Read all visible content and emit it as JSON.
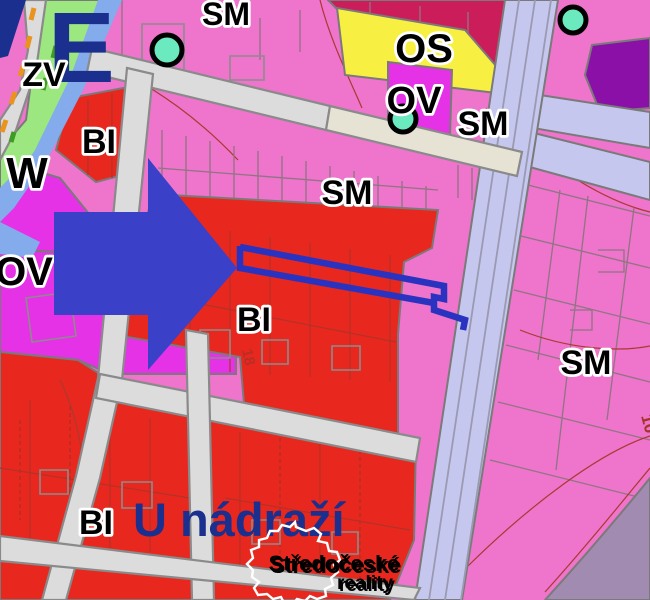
{
  "map": {
    "city_label_partial": "E",
    "street_label": "U nádraží",
    "zone_labels": {
      "sm": "SM",
      "os": "OS",
      "ov": "OV",
      "bi": "BI",
      "zv": "ZV",
      "w": "W"
    },
    "parcel_numbers": {
      "center": "18",
      "top_right": "10"
    },
    "watermark": {
      "brand_line1": "Středočeské",
      "brand_line2": "reality"
    },
    "colors": {
      "sm_pink": "#ee74cc",
      "bi_red": "#e8281e",
      "ov_magenta": "#e632e6",
      "os_yellow": "#f8ef43",
      "zv_green": "#9ce77f",
      "crimson_zone": "#cc1d5b",
      "dark_purple_zone": "#8a10a8",
      "rail_lavender": "#c5c7ef",
      "water_blue": "#84abec",
      "road_gray": "#dcdcdc",
      "road_beige": "#e6e2d4",
      "muted_purple": "#a18bb0",
      "poi_teal": "#6ceabf",
      "highlight_blue": "#3a40c8",
      "outline_blue": "#2a33c0",
      "navy_text": "#1b2f8e"
    }
  }
}
